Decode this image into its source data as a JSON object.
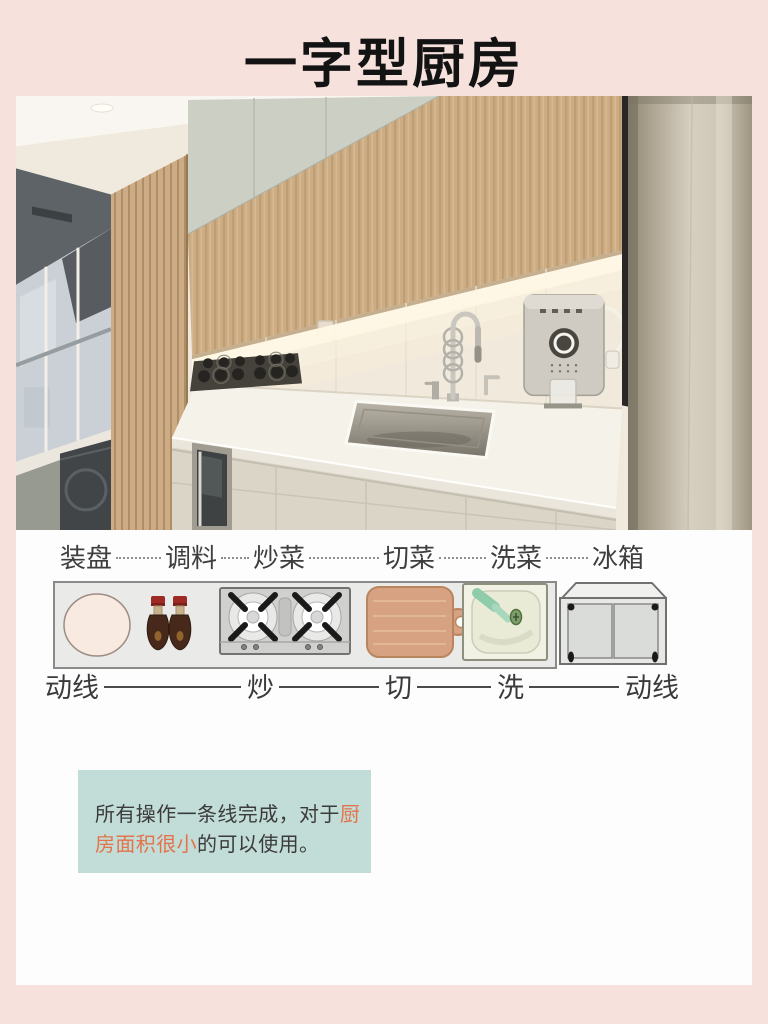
{
  "page": {
    "title": "一字型厨房"
  },
  "colors": {
    "page_bg": "#F7E1DD",
    "card_bg": "#FDFDFD",
    "note_bg": "#C2DDD7",
    "note_highlight": "#E2734B",
    "label_text": "#3E3E3E"
  },
  "diagram": {
    "stations": [
      {
        "label": "装盘",
        "icon": "plate-icon"
      },
      {
        "label": "调料",
        "icon": "sauce-bottles-icon"
      },
      {
        "label": "炒菜",
        "icon": "stove-icon"
      },
      {
        "label": "切菜",
        "icon": "cutting-board-icon"
      },
      {
        "label": "洗菜",
        "icon": "sink-icon"
      },
      {
        "label": "冰箱",
        "icon": "fridge-icon"
      }
    ],
    "flow": [
      {
        "label": "动线"
      },
      {
        "label": "炒"
      },
      {
        "label": "切"
      },
      {
        "label": "洗"
      },
      {
        "label": "动线"
      }
    ]
  },
  "note": {
    "segments": [
      {
        "text": "所有操作一条线完成，对于",
        "highlight": false
      },
      {
        "text": "厨房面积很小",
        "highlight": true
      },
      {
        "text": "的可以使用。",
        "highlight": false
      }
    ]
  }
}
